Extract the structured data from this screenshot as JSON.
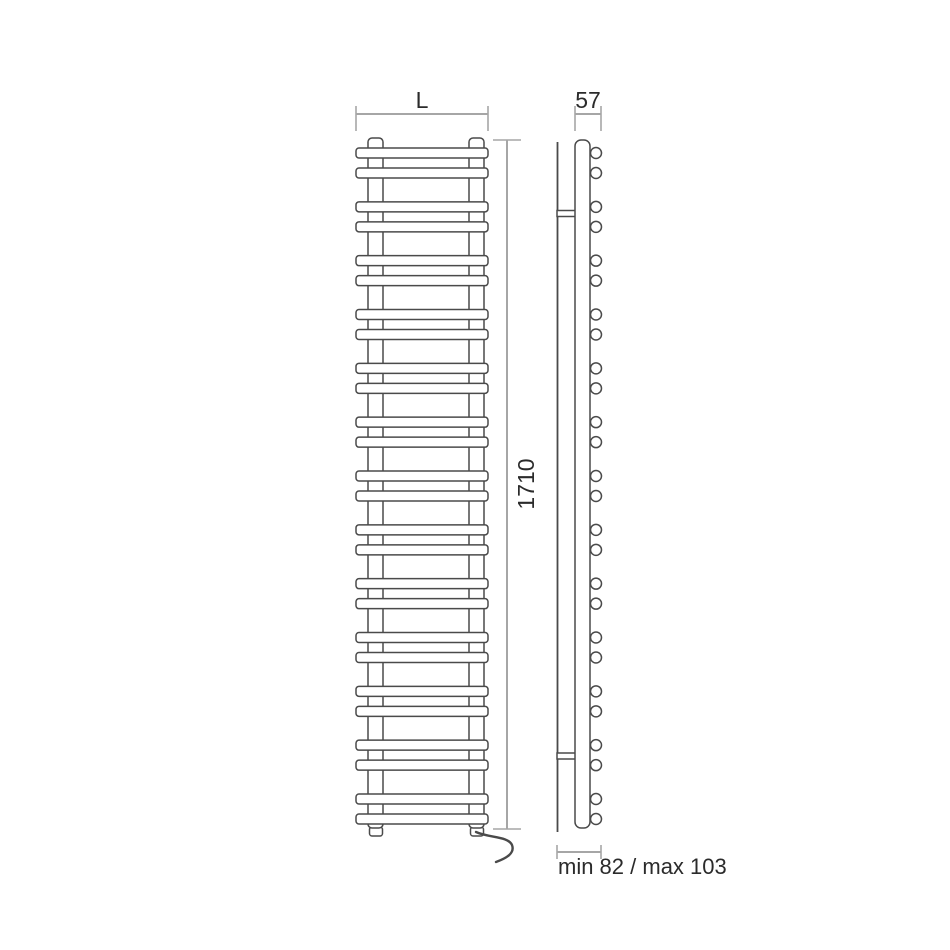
{
  "canvas": {
    "width": 950,
    "height": 950,
    "background": "#ffffff"
  },
  "colors": {
    "drawing_line": "#4a4a4a",
    "dimension_line": "#a6a6a6",
    "text": "#2b2b2b",
    "fill": "#ffffff"
  },
  "labels": {
    "width": "L",
    "depth": "57",
    "height": "1710",
    "wall_distance": "min 82 / max 103"
  },
  "front_view": {
    "bar_pairs": 13,
    "bar": {
      "x": 356,
      "width": 132,
      "height": 10,
      "radius": 3
    },
    "first_bar_top": 148,
    "pair_inner_gap": 10,
    "group_pitch": 53.833,
    "collector_top": 138,
    "collector_bottom": 828,
    "collectors": [
      {
        "x": 368,
        "width": 15
      },
      {
        "x": 469,
        "width": 15
      }
    ],
    "foot_top": 827,
    "foot_height": 9,
    "feet": [
      {
        "x": 369.5,
        "width": 13
      },
      {
        "x": 470.5,
        "width": 13
      }
    ],
    "cable_path": "M 476 832 C 489 838 508 836 512 845 C 515 853 507 858 496 862"
  },
  "side_view": {
    "wall_x": 557.5,
    "wall_top": 142,
    "wall_bottom": 832,
    "panel": {
      "x": 575,
      "width": 15,
      "top": 140,
      "bottom": 828,
      "radius": 6
    },
    "tube_cx": 596,
    "tube_r": 5.5,
    "tube_count": 26,
    "brackets_y": [
      210.5,
      753
    ],
    "bracket_height": 6
  },
  "dimensions": {
    "width_dim": {
      "y": 114,
      "x1": 356,
      "x2": 488,
      "tick_top": 106,
      "tick_bottom": 131,
      "label_x": 422,
      "label_y": 108
    },
    "depth_dim": {
      "y": 114,
      "x1": 575,
      "x2": 601,
      "tick_top": 106,
      "tick_bottom": 131,
      "label_x": 588,
      "label_y": 108
    },
    "height_dim": {
      "x": 507,
      "y1": 140,
      "y2": 829,
      "tick_x1": 493,
      "tick_x2": 521,
      "label_x": 534,
      "label_y": 484
    },
    "wall_dim": {
      "y": 852,
      "x1": 557,
      "x2": 601,
      "tick_top": 845,
      "tick_bottom": 859,
      "label_x": 558,
      "label_y": 874
    }
  }
}
